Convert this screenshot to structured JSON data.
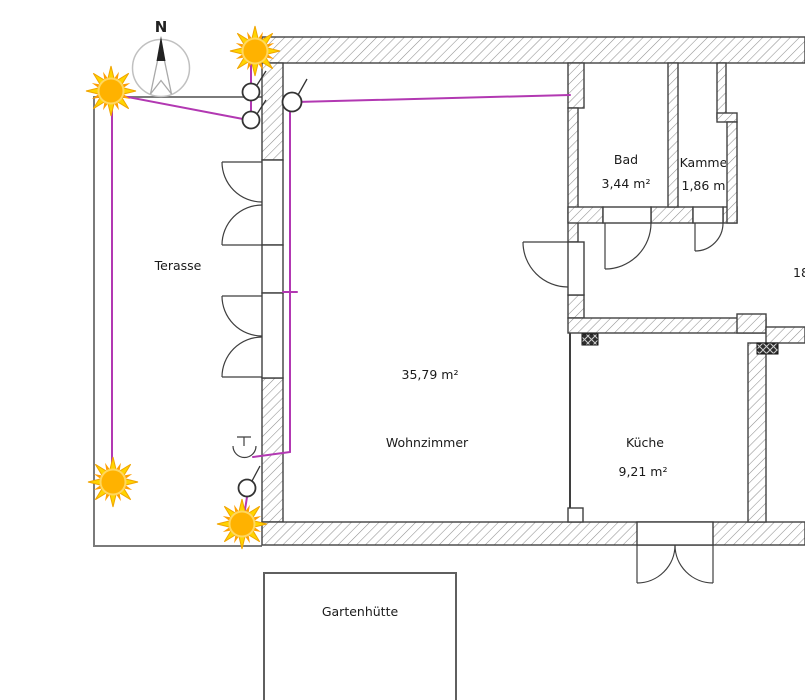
{
  "compass": {
    "north_label": "N"
  },
  "rooms": [
    {
      "name": "Terasse",
      "area_label": ""
    },
    {
      "name": "Wohnzimmer",
      "area_label": "35,79 m²"
    },
    {
      "name": "Bad",
      "area_label": "3,44 m²"
    },
    {
      "name": "Kammer",
      "area_label": "1,86 m²"
    },
    {
      "name": "Küche",
      "area_label": "9,21 m²"
    },
    {
      "name": "Gartenhütte",
      "area_label": ""
    },
    {
      "name": "",
      "area_label": "18"
    }
  ],
  "icons": {
    "sun": "sun-icon",
    "switch": "switch-icon",
    "ceiling_lamp": "lamp-icon",
    "compass": "north-compass-icon",
    "shaft": "installation-shaft-icon"
  },
  "colors": {
    "wiring": "#b238b2",
    "sun_core": "#ffb200",
    "sun_ray": "#ffd400",
    "wall_outline": "#424242",
    "wall_hatch": "#909090",
    "terrace_outline": "#7a7a7a"
  }
}
